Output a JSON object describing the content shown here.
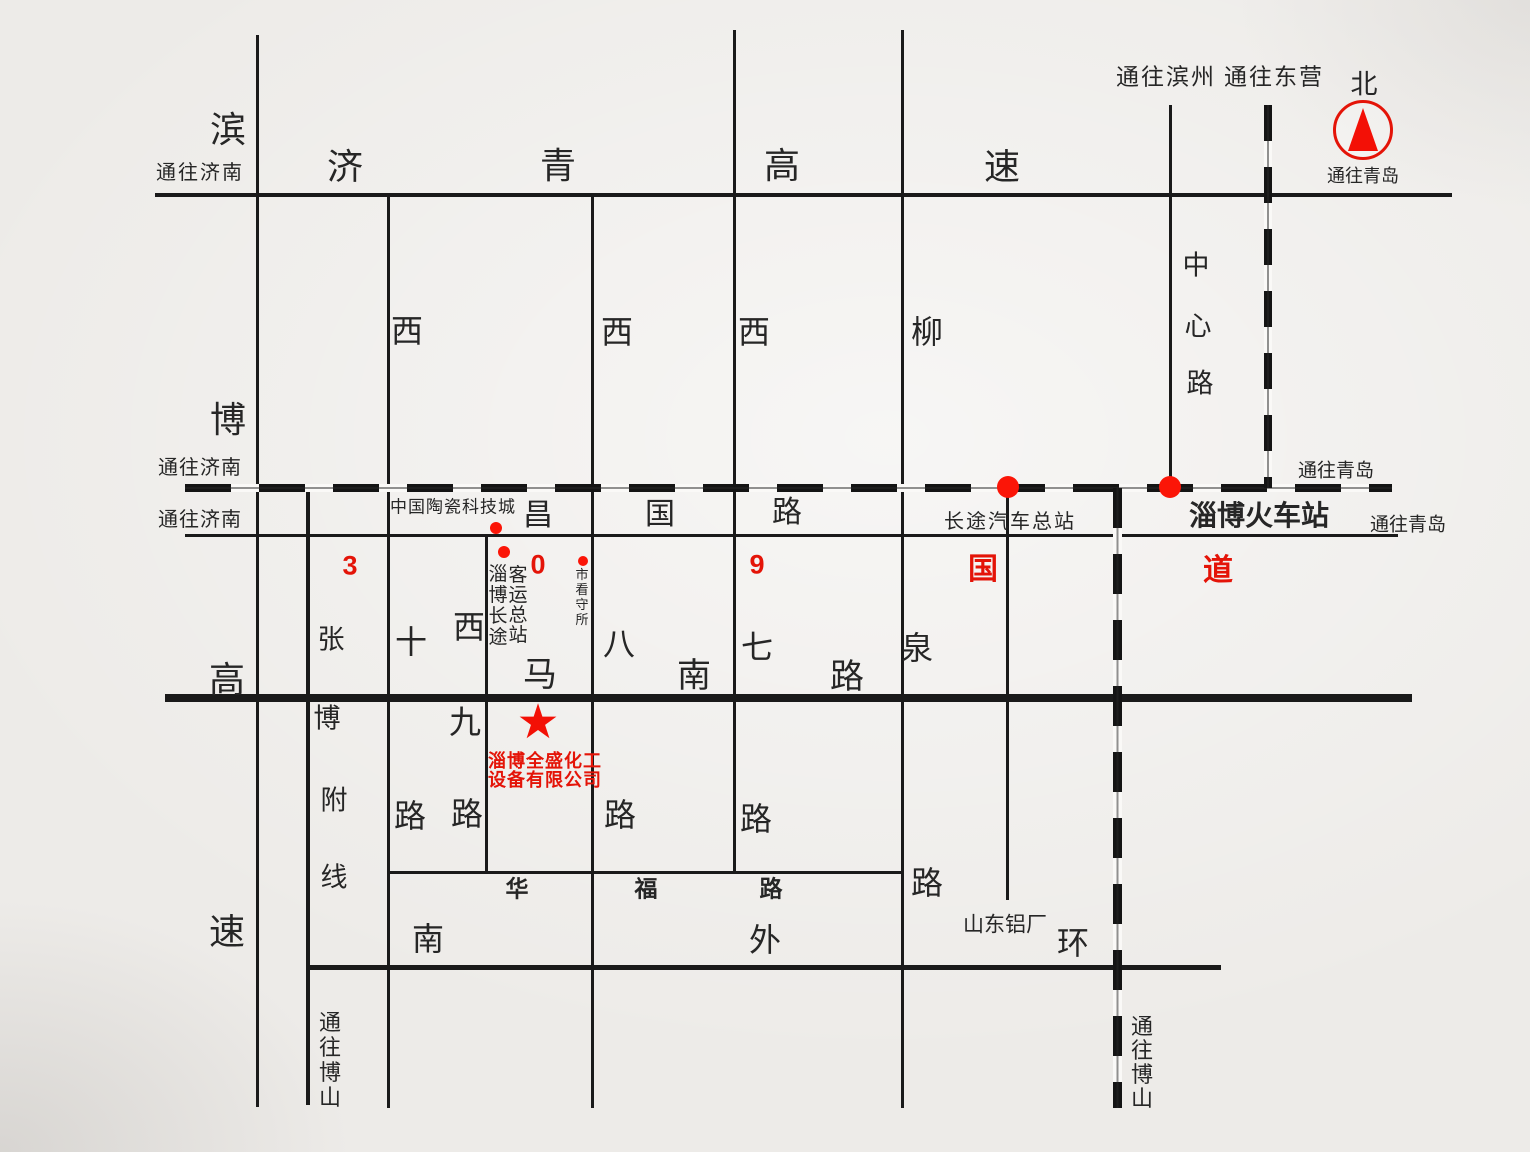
{
  "map": {
    "title": "淄博全盛化工设备有限公司位置示意图",
    "colors": {
      "background": "#edebe8",
      "line": "#1a1a1a",
      "text": "#262626",
      "red_text": "#e41408",
      "red_marker": "#fb1507"
    },
    "company": {
      "name_line1": "淄博全盛化工",
      "name_line2": "设备有限公司",
      "marker": "red-star"
    },
    "hlines": [
      {
        "n": "jiqing-expressway-line",
        "full_name": "济青高速",
        "x": 155,
        "y": 193,
        "len": 1297,
        "t": 4
      },
      {
        "n": "changguo-road-line",
        "full_name": "昌国路 (309国道)",
        "x": 185,
        "y": 534,
        "len": 1213,
        "t": 3
      },
      {
        "n": "manan-road-line",
        "full_name": "马南路",
        "x": 165,
        "y": 694,
        "len": 1247,
        "t": 8
      },
      {
        "n": "huafu-road-line",
        "full_name": "华福路",
        "x": 389,
        "y": 871,
        "len": 514,
        "t": 3
      },
      {
        "n": "south-outer-ring-line",
        "full_name": "南外环",
        "x": 308,
        "y": 965,
        "len": 913,
        "t": 5
      }
    ],
    "vlines": [
      {
        "n": "binbo-expressway-line",
        "full_name": "滨博高速",
        "x": 256,
        "y": 35,
        "len": 1072,
        "t": 3
      },
      {
        "n": "zhangbo-branch-line",
        "full_name": "张博附线",
        "x": 306,
        "y": 490,
        "len": 615,
        "t": 4
      },
      {
        "n": "xi-shi-road-line",
        "full_name": "西十路",
        "x": 387,
        "y": 197,
        "len": 911,
        "t": 3
      },
      {
        "n": "xi-jiu-road-line",
        "full_name": "西九路",
        "x": 485,
        "y": 536,
        "len": 337,
        "t": 3
      },
      {
        "n": "xi-ba-road-line",
        "full_name": "西八路",
        "x": 591,
        "y": 197,
        "len": 911,
        "t": 3
      },
      {
        "n": "xi-qi-road-line",
        "full_name": "西七路",
        "x": 733,
        "y": 30,
        "len": 843,
        "t": 3
      },
      {
        "n": "liuquan-road-line",
        "full_name": "柳泉路",
        "x": 901,
        "y": 30,
        "len": 1078,
        "t": 3
      },
      {
        "n": "bus-terminal-road-line",
        "full_name": "长途汽车总站连接路",
        "x": 1006,
        "y": 488,
        "len": 412,
        "t": 3
      },
      {
        "n": "zhongxin-road-line",
        "full_name": "中心路",
        "x": 1169,
        "y": 105,
        "len": 385,
        "t": 3
      }
    ],
    "railways": [
      {
        "n": "railway-horizontal",
        "o": "h",
        "x": 185,
        "y": 484,
        "len": 1207,
        "t": 8,
        "dash": 46,
        "gap": 28
      },
      {
        "n": "railway-vertical-north",
        "o": "v",
        "x": 1264,
        "y": 105,
        "len": 383,
        "t": 8,
        "dash": 36,
        "gap": 26
      },
      {
        "n": "railway-vertical-south",
        "o": "v",
        "x": 1113,
        "y": 488,
        "len": 620,
        "t": 9,
        "dash": 40,
        "gap": 26
      }
    ],
    "labels": [
      {
        "n": "to-jinan-expressway-label",
        "t": "通往济南",
        "x": 200,
        "y": 173,
        "fs": 20,
        "ls": 2
      },
      {
        "n": "jiqing-char-ji",
        "t": "济",
        "x": 345,
        "y": 167,
        "fs": 36
      },
      {
        "n": "jiqing-char-qing",
        "t": "青",
        "x": 558,
        "y": 166,
        "fs": 36
      },
      {
        "n": "jiqing-char-gao",
        "t": "高",
        "x": 782,
        "y": 166,
        "fs": 36
      },
      {
        "n": "jiqing-char-su",
        "t": "速",
        "x": 1002,
        "y": 167,
        "fs": 36
      },
      {
        "n": "to-binzhou-label",
        "t": "通往滨州",
        "x": 1166,
        "y": 77,
        "fs": 23,
        "ls": 2
      },
      {
        "n": "to-dongying-label",
        "t": "通往东营",
        "x": 1274,
        "y": 77,
        "fs": 23,
        "ls": 2
      },
      {
        "n": "north-label",
        "t": "北",
        "x": 1364,
        "y": 85,
        "fs": 27
      },
      {
        "n": "to-qingdao-compass-label",
        "t": "通往青岛",
        "x": 1363,
        "y": 176,
        "fs": 18
      },
      {
        "n": "to-jinan-railway-label",
        "t": "通往济南",
        "x": 200,
        "y": 468,
        "fs": 20,
        "ls": 1
      },
      {
        "n": "to-jinan-changguo-label",
        "t": "通往济南",
        "x": 200,
        "y": 520,
        "fs": 20,
        "ls": 1
      },
      {
        "n": "ceramic-city-label",
        "t": "中国陶瓷科技城",
        "x": 453,
        "y": 507,
        "fs": 17,
        "ls": 1
      },
      {
        "n": "changguo-char-chang",
        "t": "昌",
        "x": 538,
        "y": 516,
        "fs": 30
      },
      {
        "n": "changguo-char-guo",
        "t": "国",
        "x": 660,
        "y": 515,
        "fs": 30
      },
      {
        "n": "changguo-char-lu",
        "t": "路",
        "x": 787,
        "y": 513,
        "fs": 30
      },
      {
        "n": "bus-terminal-label",
        "t": "长途汽车总站",
        "x": 1010,
        "y": 522,
        "fs": 20,
        "ls": 2
      },
      {
        "n": "zibo-railway-station-label",
        "t": "淄博火车站",
        "x": 1259,
        "y": 516,
        "fs": 28,
        "b": 1
      },
      {
        "n": "to-qingdao-railway-label",
        "t": "通往青岛",
        "x": 1336,
        "y": 471,
        "fs": 19
      },
      {
        "n": "to-qingdao-changguo-label",
        "t": "通往青岛",
        "x": 1408,
        "y": 525,
        "fs": 19
      },
      {
        "n": "g309-char-3",
        "t": "3",
        "x": 350,
        "y": 566,
        "fs": 27,
        "b": 1,
        "r": 1
      },
      {
        "n": "g309-char-0",
        "t": "0",
        "x": 538,
        "y": 565,
        "fs": 27,
        "b": 1,
        "r": 1
      },
      {
        "n": "g309-char-9",
        "t": "9",
        "x": 757,
        "y": 565,
        "fs": 27,
        "b": 1,
        "r": 1
      },
      {
        "n": "g309-char-guo",
        "t": "国",
        "x": 983,
        "y": 570,
        "fs": 30,
        "b": 1,
        "r": 1
      },
      {
        "n": "g309-char-dao",
        "t": "道",
        "x": 1218,
        "y": 571,
        "fs": 30,
        "b": 1,
        "r": 1
      },
      {
        "n": "manan-char-ma",
        "t": "马",
        "x": 540,
        "y": 675,
        "fs": 34
      },
      {
        "n": "manan-char-nan",
        "t": "南",
        "x": 694,
        "y": 676,
        "fs": 34
      },
      {
        "n": "manan-char-lu",
        "t": "路",
        "x": 847,
        "y": 677,
        "fs": 34
      },
      {
        "n": "xiba-char-ba",
        "t": "八",
        "x": 619,
        "y": 644,
        "fs": 32
      },
      {
        "n": "xiqi-char-qi",
        "t": "七",
        "x": 757,
        "y": 647,
        "fs": 32
      },
      {
        "n": "liuquan-char-quan",
        "t": "泉",
        "x": 917,
        "y": 648,
        "fs": 32
      },
      {
        "n": "liuquan-char-liu",
        "t": "柳",
        "x": 927,
        "y": 332,
        "fs": 32
      },
      {
        "n": "xishi-char-xi",
        "t": "西",
        "x": 407,
        "y": 331,
        "fs": 32
      },
      {
        "n": "xiba-char-xi",
        "t": "西",
        "x": 617,
        "y": 332,
        "fs": 32
      },
      {
        "n": "xiqi-char-xi",
        "t": "西",
        "x": 754,
        "y": 332,
        "fs": 32
      },
      {
        "n": "xishi-char-shi",
        "t": "十",
        "x": 411,
        "y": 642,
        "fs": 32
      },
      {
        "n": "xijiu-char-xi",
        "t": "西",
        "x": 469,
        "y": 627,
        "fs": 32
      },
      {
        "n": "xijiu-char-jiu",
        "t": "九",
        "x": 465,
        "y": 722,
        "fs": 32
      },
      {
        "n": "xishi-char-lu",
        "t": "路",
        "x": 410,
        "y": 816,
        "fs": 32
      },
      {
        "n": "xijiu-char-lu",
        "t": "路",
        "x": 467,
        "y": 814,
        "fs": 32
      },
      {
        "n": "xiba-char-lu",
        "t": "路",
        "x": 620,
        "y": 815,
        "fs": 32
      },
      {
        "n": "xiqi-char-lu",
        "t": "路",
        "x": 756,
        "y": 819,
        "fs": 32
      },
      {
        "n": "liuquan-char-lu",
        "t": "路",
        "x": 927,
        "y": 883,
        "fs": 32
      },
      {
        "n": "huafu-char-hua",
        "t": "华",
        "x": 517,
        "y": 889,
        "fs": 23,
        "b": 1
      },
      {
        "n": "huafu-char-fu",
        "t": "福",
        "x": 646,
        "y": 889,
        "fs": 23,
        "b": 1
      },
      {
        "n": "huafu-char-lu",
        "t": "路",
        "x": 771,
        "y": 889,
        "fs": 23,
        "b": 1
      },
      {
        "n": "waihuan-char-nan",
        "t": "南",
        "x": 428,
        "y": 939,
        "fs": 32
      },
      {
        "n": "waihuan-char-wai",
        "t": "外",
        "x": 765,
        "y": 940,
        "fs": 32
      },
      {
        "n": "waihuan-char-huan",
        "t": "环",
        "x": 1073,
        "y": 943,
        "fs": 32
      },
      {
        "n": "shandong-aluminum-label",
        "t": "山东铝厂",
        "x": 1005,
        "y": 925,
        "fs": 21
      },
      {
        "n": "binbo-char-bin",
        "t": "滨",
        "x": 228,
        "y": 130,
        "fs": 36
      },
      {
        "n": "binbo-char-bo",
        "t": "博",
        "x": 228,
        "y": 420,
        "fs": 36
      },
      {
        "n": "binbo-char-gao",
        "t": "高",
        "x": 227,
        "y": 680,
        "fs": 36
      },
      {
        "n": "binbo-char-su",
        "t": "速",
        "x": 227,
        "y": 932,
        "fs": 36
      },
      {
        "n": "zhangbo-char-zhang",
        "t": "张",
        "x": 331,
        "y": 640,
        "fs": 27
      },
      {
        "n": "zhangbo-char-bo",
        "t": "博",
        "x": 327,
        "y": 719,
        "fs": 27
      },
      {
        "n": "zhangbo-char-fu",
        "t": "附",
        "x": 334,
        "y": 801,
        "fs": 27
      },
      {
        "n": "zhangbo-char-xian",
        "t": "线",
        "x": 334,
        "y": 878,
        "fs": 27
      },
      {
        "n": "zhongxin-char-zhong",
        "t": "中",
        "x": 1196,
        "y": 266,
        "fs": 27
      },
      {
        "n": "zhongxin-char-xin",
        "t": "心",
        "x": 1198,
        "y": 327,
        "fs": 27
      },
      {
        "n": "zhongxin-char-lu",
        "t": "路",
        "x": 1200,
        "y": 384,
        "fs": 27
      },
      {
        "n": "company-name-line1",
        "t": "淄博全盛化工",
        "x": 545,
        "y": 761,
        "fs": 18,
        "b": 1,
        "r": 1,
        "ls": 1
      },
      {
        "n": "company-name-line2",
        "t": "设备有限公司",
        "x": 545,
        "y": 780,
        "fs": 18,
        "b": 1,
        "r": 1,
        "ls": 1
      }
    ],
    "vertical_labels": [
      {
        "n": "zibo-bus-terminal-col-left",
        "t": "淄博长途",
        "x": 498,
        "y": 564,
        "fs": 19,
        "lh": 21
      },
      {
        "n": "zibo-bus-terminal-col-right",
        "t": "客运总站",
        "x": 518,
        "y": 566,
        "fs": 19,
        "lh": 20
      },
      {
        "n": "detention-house-label",
        "t": "市看守所",
        "x": 582,
        "y": 567,
        "fs": 13,
        "lh": 15
      },
      {
        "n": "to-boshan-left-label",
        "t": "通往博山",
        "x": 330,
        "y": 1010,
        "fs": 22,
        "lh": 25
      },
      {
        "n": "to-boshan-right-label",
        "t": "通往博山",
        "x": 1142,
        "y": 1015,
        "fs": 22,
        "lh": 24
      }
    ],
    "dots": [
      {
        "n": "ceramic-city-dot",
        "x": 496,
        "y": 528,
        "r": 6
      },
      {
        "n": "bus-terminal-west-dot",
        "x": 504,
        "y": 552,
        "r": 6
      },
      {
        "n": "detention-house-dot",
        "x": 583,
        "y": 561,
        "r": 5
      },
      {
        "n": "bus-station-railway-dot",
        "x": 1008,
        "y": 487,
        "r": 11
      },
      {
        "n": "railway-station-railway-dot",
        "x": 1170,
        "y": 487,
        "r": 11
      }
    ],
    "star": {
      "n": "company-star-marker",
      "x": 538,
      "y": 722,
      "size": 48,
      "glyph": "★"
    },
    "compass": {
      "n": "compass-north",
      "x": 1363,
      "y": 130,
      "r": 27
    }
  }
}
